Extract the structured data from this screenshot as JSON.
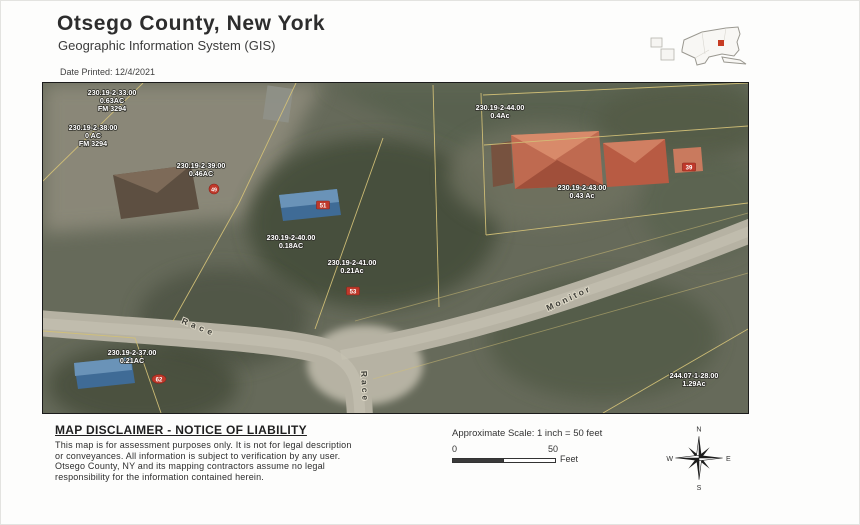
{
  "header": {
    "title": "Otsego County, New York",
    "subtitle": "Geographic Information System (GIS)",
    "date_printed": "Date Printed: 12/4/2021"
  },
  "map": {
    "parcels": [
      {
        "id": "230.19-2-33.00",
        "area": "0.63AC",
        "fm": "FM 3294"
      },
      {
        "id": "230.19-2-38.00",
        "area": "0 AC",
        "fm": "FM 3294"
      },
      {
        "id": "230.19-2-39.00",
        "area": "0.46AC"
      },
      {
        "id": "230.19-2-44.00",
        "area": "0.4Ac"
      },
      {
        "id": "230.19-2-43.00",
        "area": "0.43 Ac"
      },
      {
        "id": "230.19-2-40.00",
        "area": "0.18AC"
      },
      {
        "id": "230.19-2-41.00",
        "area": "0.21Ac"
      },
      {
        "id": "230.19-2-37.00",
        "area": "0.21AC"
      },
      {
        "id": "244.07-1-28.00",
        "area": "1.29Ac"
      }
    ],
    "streets": [
      {
        "name": "Race"
      },
      {
        "name": "Race"
      },
      {
        "name": "Monitor"
      }
    ],
    "address_markers": [
      {
        "value": "49"
      },
      {
        "value": "51"
      },
      {
        "value": "53"
      },
      {
        "value": "62"
      },
      {
        "value": "39"
      }
    ]
  },
  "footer": {
    "disclaimer_title": "MAP DISCLAIMER - NOTICE OF LIABILITY",
    "disclaimer_lines": [
      "This map is for assessment purposes only. It is not for legal description",
      "or conveyances. All information is subject to verification by any user.",
      "Otsego County, NY and its mapping contractors assume no legal",
      "responsibility for the information contained herein."
    ],
    "scale": {
      "label": "Approximate Scale: 1 inch = 50 feet",
      "start": "0",
      "end": "50",
      "unit": "Feet"
    },
    "compass": {
      "n": "N",
      "s": "S",
      "e": "E",
      "w": "W"
    }
  },
  "colors": {
    "parcel_line": "#d2c077",
    "marker_red": "#c0392b",
    "road": "#b6b2a3",
    "aerial_base": "#666a5a",
    "building_blue": "#3f6b96",
    "building_red": "#bf6a50",
    "locator_highlight": "#c63b22"
  }
}
